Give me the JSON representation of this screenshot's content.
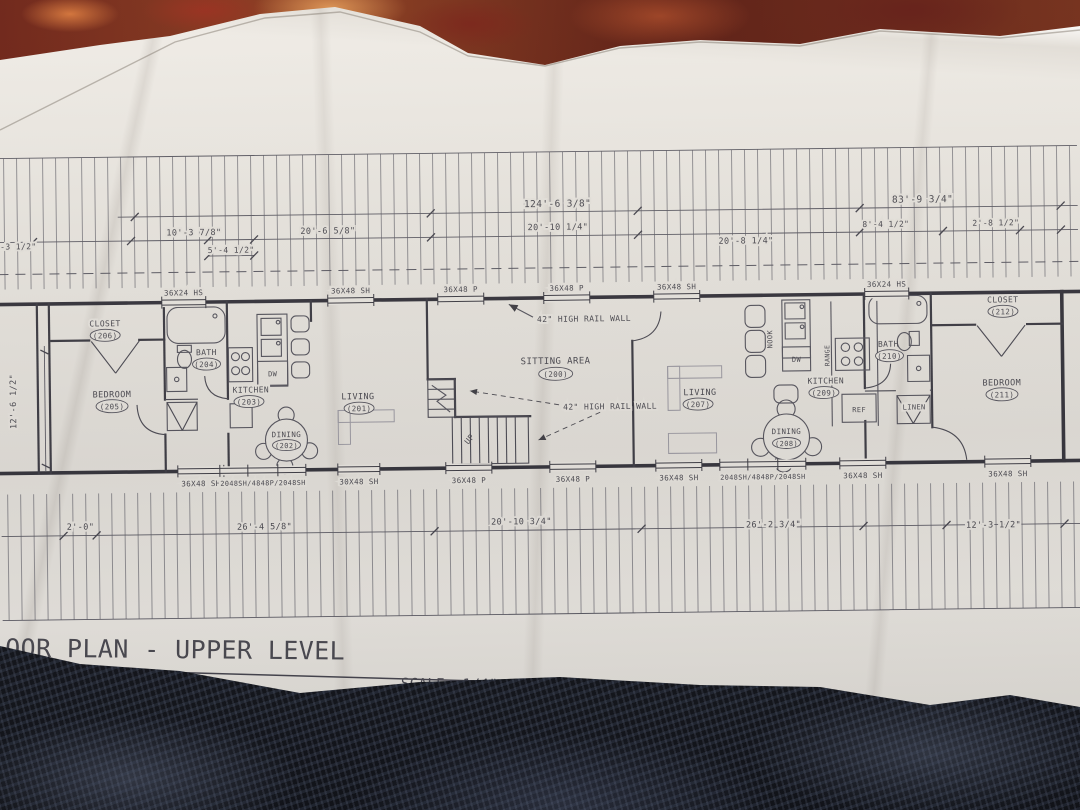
{
  "colors": {
    "paper": "#e3e0da",
    "ink": "#4a4950",
    "wall": "#34333b",
    "carpet_dark": "#14161d",
    "carpet_red": "#6b2014"
  },
  "title": {
    "main": "OOR PLAN - UPPER LEVEL",
    "scale": "SCALE: 1/4\" = 1'-0\""
  },
  "rooms": {
    "sitting": {
      "name": "SITTING AREA",
      "num": "(200)"
    },
    "living_l": {
      "name": "LIVING",
      "num": "(201)"
    },
    "dining_l": {
      "name": "DINING",
      "num": "(202)"
    },
    "kitchen_l": {
      "name": "KITCHEN",
      "num": "(203)"
    },
    "bath_l": {
      "name": "BATH",
      "num": "(204)"
    },
    "bedroom_l": {
      "name": "BEDROOM",
      "num": "(205)"
    },
    "closet_l": {
      "name": "CLOSET",
      "num": "(206)"
    },
    "living_r": {
      "name": "LIVING",
      "num": "(207)"
    },
    "dining_r": {
      "name": "DINING",
      "num": "(208)"
    },
    "kitchen_r": {
      "name": "KITCHEN",
      "num": "(209)"
    },
    "bath_r": {
      "name": "BATH",
      "num": "(210)"
    },
    "bedroom_r": {
      "name": "BEDROOM",
      "num": "(211)"
    },
    "closet_r": {
      "name": "CLOSET",
      "num": "(212)"
    }
  },
  "fixtures": {
    "dw_l": "DW",
    "dw_r": "DW",
    "ref": "REF",
    "range": "RANGE",
    "nook": "NOOK",
    "linen": "LINEN",
    "up": "UP"
  },
  "windows_top": [
    "36X24 HS",
    "36X48 SH",
    "36X48 P",
    "36X48 P",
    "36X48 SH",
    "36X24 HS"
  ],
  "windows_bottom": [
    "36X48 SH",
    "2048SH/4848P/2048SH",
    "30X48 SH",
    "36X48 P",
    "36X48 P",
    "36X48 SH",
    "2048SH/4848P/2048SH",
    "36X48 SH",
    "36X48 SH"
  ],
  "dims_top": [
    "124'-6 3/8\"",
    "10'-3 7/8\"",
    "5'-4 1/2\"",
    "20'-6 5/8\"",
    "20'-10 1/4\"",
    "20'-8 1/4\"",
    "83'-9 3/4\"",
    "8'-4 1/2\"",
    "2'-8 1/2\"",
    "-3 1/2\""
  ],
  "dims_bottom": [
    "2'-0\"",
    "26'-4 5/8\"",
    "20'-10 3/4\"",
    "26'-2 3/4\"",
    "12'-3 1/2\""
  ],
  "dims_left": [
    "12'-6 1/2\""
  ],
  "notes": {
    "rail1": "42\" HIGH RAIL WALL",
    "rail2": "42\" HIGH RAIL WALL"
  }
}
